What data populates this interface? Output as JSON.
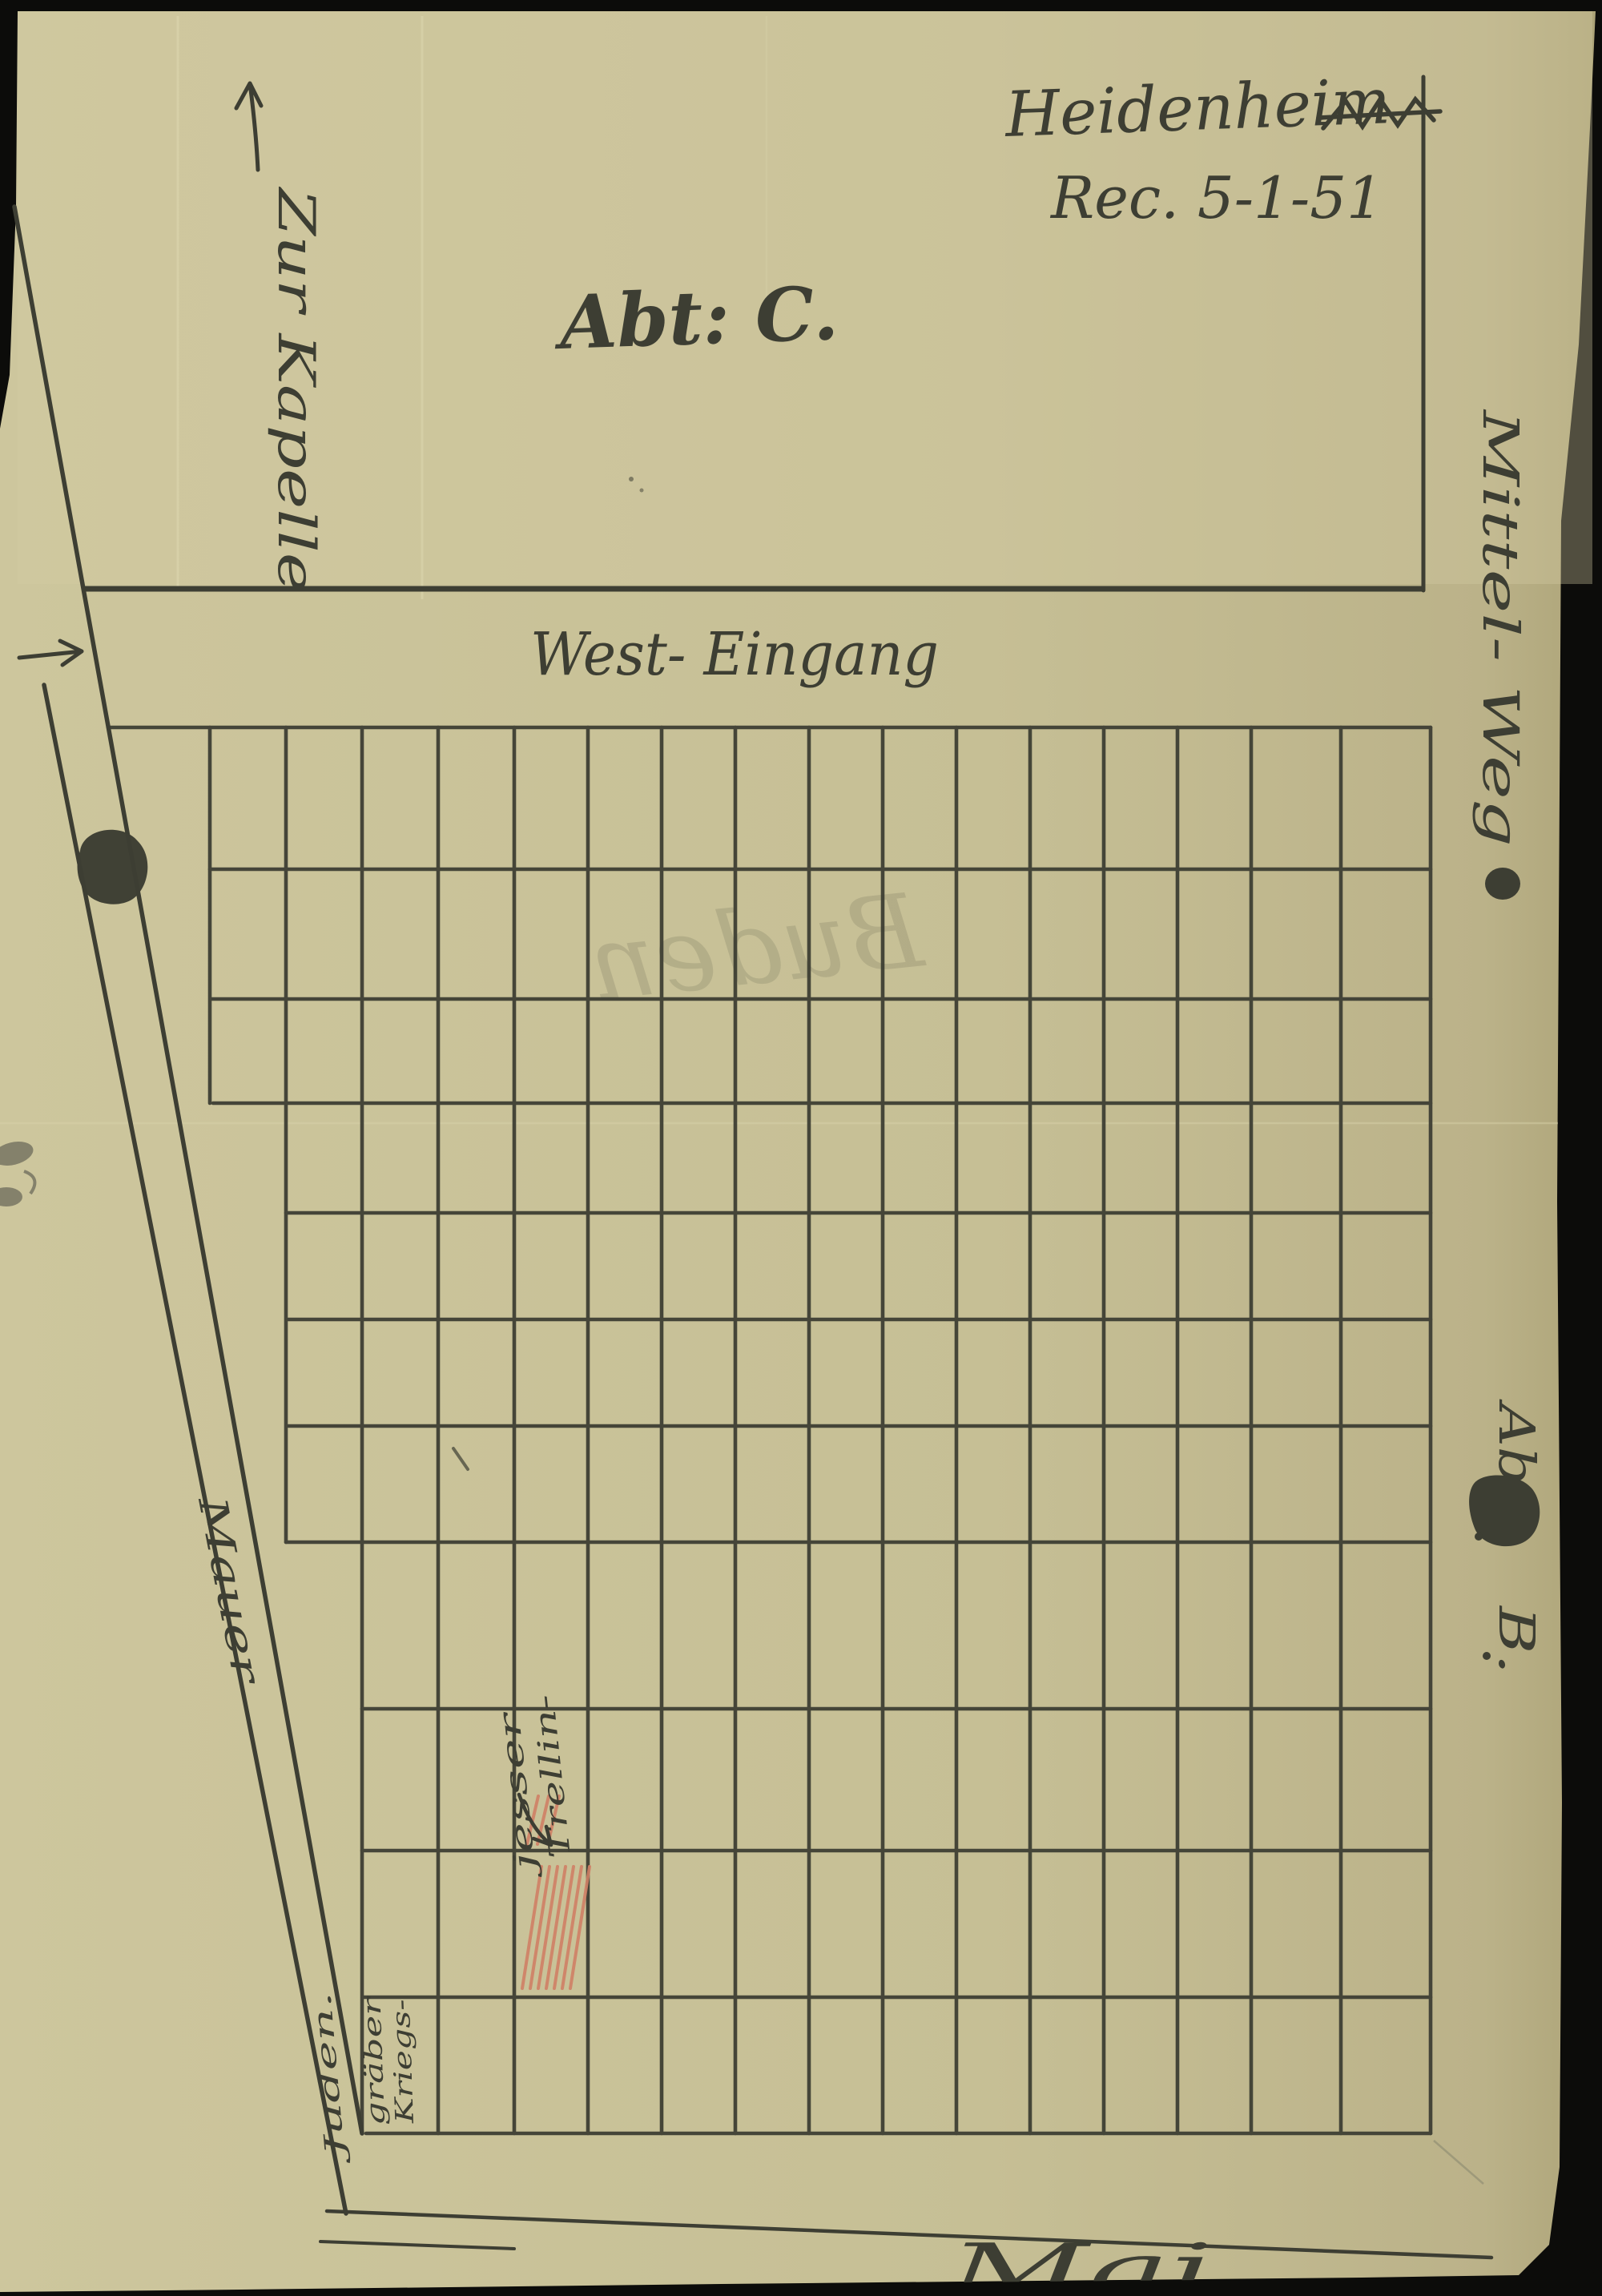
{
  "page": {
    "header": {
      "location": "Heidenheim",
      "received": "Rec. 5-1-51"
    },
    "sections": {
      "c_label": "Abt: C.",
      "b_label_line1": "Abt.",
      "b_label_line2": "B."
    },
    "paths": {
      "to_chapel": "Zur Kapelle",
      "west_entrance": "West- Eingang",
      "middle_way": "Mittel- Weg",
      "wall": "Mauer",
      "bottom_edge_partial": "Mai"
    },
    "grave_annotations": {
      "marked_grave_line1": "Trellin-",
      "marked_grave_line2": "jesser",
      "corner_cell_line1": "Kriegs-",
      "corner_cell_line2": "gräber",
      "outside_corner": "Juden."
    },
    "bleed_through_text": "Buden",
    "colors": {
      "paper": "#c9c199",
      "paper_shadow": "#b2aa7f",
      "ink": "#3d3e33",
      "red_hatch": "#d08066",
      "scan_background": "#0c0c0a"
    }
  }
}
